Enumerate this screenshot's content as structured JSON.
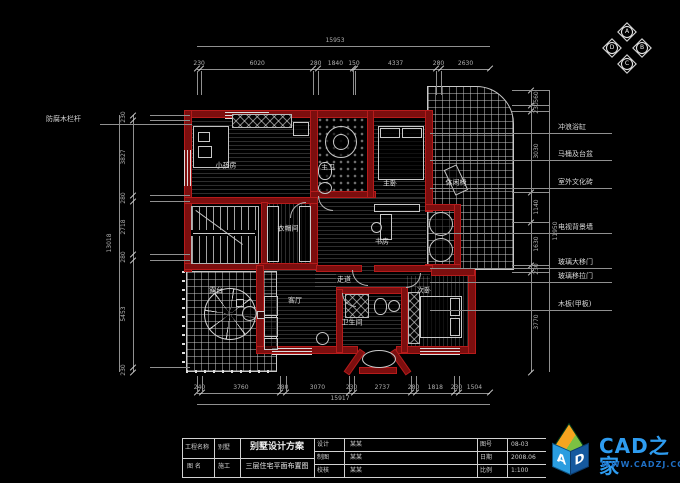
{
  "drawing": {
    "type": "floor-plan",
    "background": "#000000",
    "wall_color": "#7c0e0e",
    "line_color": "#c9c9c9"
  },
  "compass": {
    "top": "A",
    "right": "B",
    "bottom": "C",
    "left": "D"
  },
  "dimensions": {
    "top": {
      "total": "15953",
      "segments": [
        "230",
        "6020",
        "280",
        "1840",
        "150",
        "4337",
        "280",
        "2630"
      ]
    },
    "bottom": {
      "total": "15917",
      "segments": [
        "240",
        "3760",
        "280",
        "3070",
        "230",
        "2737",
        "280",
        "1818",
        "230",
        "1504"
      ]
    },
    "left": {
      "total": "13018",
      "segments": [
        "230",
        "3827",
        "280",
        "2718",
        "280",
        "5453",
        "230"
      ]
    },
    "right": {
      "total": "11950",
      "segments": [
        "560",
        "230",
        "3030",
        "1140",
        "1630",
        "230",
        "3770"
      ]
    }
  },
  "annotations": {
    "left_label": "防腐木栏杆",
    "right_labels": [
      "冲浪浴缸",
      "马桶及台盆",
      "室外文化砖",
      "电视背景墙",
      "玻璃大移门",
      "玻璃移拉门",
      "木板(甲板)"
    ]
  },
  "plan": {
    "rooms": [
      "小孩房",
      "衣帽间",
      "主卫",
      "主卧",
      "书房",
      "休闲椅",
      "露台",
      "客厅",
      "走道",
      "卫生间",
      "次卧"
    ]
  },
  "titleblock": {
    "project_label": "工程名称",
    "project_value": "别墅",
    "project_title": "别墅设计方案",
    "drawing_label": "图 名",
    "drawing_value": "施工",
    "drawing_title": "三层住宅平面布置图",
    "col_a": [
      {
        "k": "设计",
        "v": "某某"
      },
      {
        "k": "制图",
        "v": "某某"
      },
      {
        "k": "校核",
        "v": "某某"
      }
    ],
    "col_b": [
      {
        "k": "图号",
        "v": "08-03"
      },
      {
        "k": "日期",
        "v": "2008.06"
      },
      {
        "k": "比例",
        "v": "1:100"
      }
    ]
  },
  "logo": {
    "title": "CAD之家",
    "url": "WWW.CADZJ.COM",
    "cube_letters": [
      "A",
      "D"
    ]
  }
}
